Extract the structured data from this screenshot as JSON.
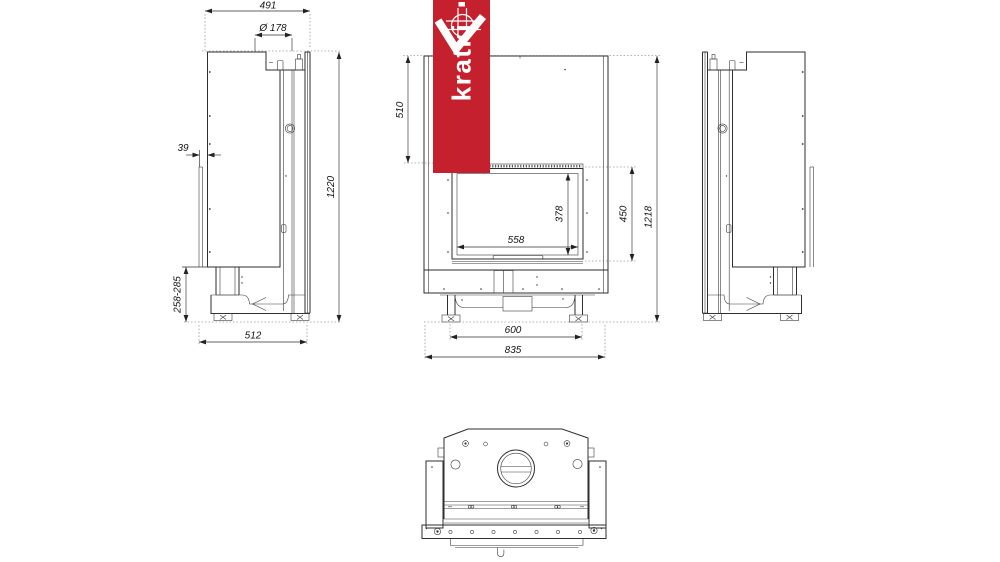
{
  "brand": {
    "name": "kratki",
    "banner_color": "#c5202e",
    "logo": "kratki-chevron-grid-mark"
  },
  "dimensions": {
    "side_view": {
      "depth_total": "491",
      "flue_diameter": "Ø 178",
      "rear_offset": "39",
      "height_total": "1220",
      "base_height_range": "258-285",
      "base_depth": "512"
    },
    "front_view": {
      "top_to_opening": "510",
      "glass_height": "378",
      "glass_width": "558",
      "opening_height": "450",
      "height_total": "1218",
      "feet_spacing": "600",
      "width_total": "835"
    }
  }
}
